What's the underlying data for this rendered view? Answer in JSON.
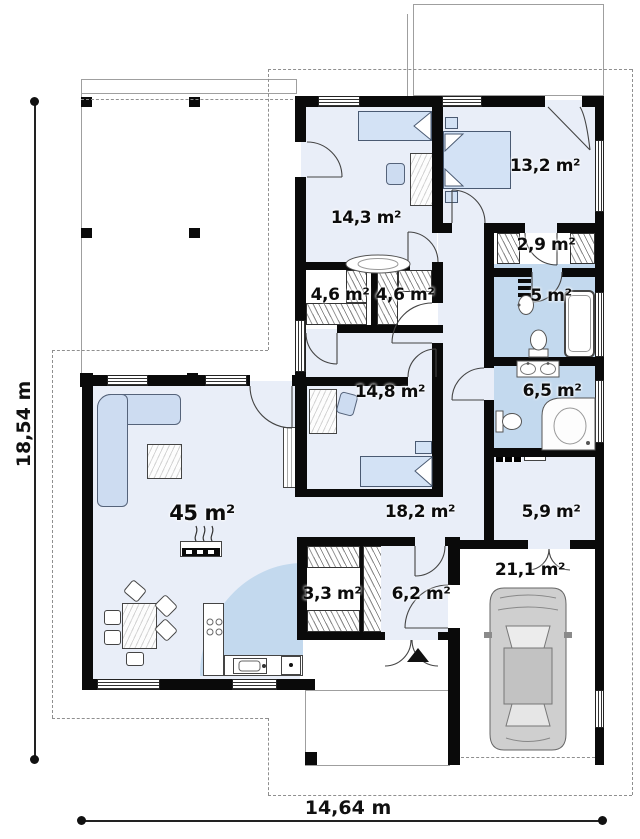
{
  "plan": {
    "type": "floor-plan",
    "rooms": [
      {
        "id": "living-room",
        "area_label": "45 m²"
      },
      {
        "id": "bedroom-1",
        "area_label": "14,3 m²"
      },
      {
        "id": "bedroom-2",
        "area_label": "13,2 m²"
      },
      {
        "id": "bedroom-3",
        "area_label": "14,8 m²"
      },
      {
        "id": "hallway",
        "area_label": "18,2 m²"
      },
      {
        "id": "wardrobe-1",
        "area_label": "2,9 m²"
      },
      {
        "id": "bathroom-1",
        "area_label": "5 m²"
      },
      {
        "id": "closet-1",
        "area_label": "4,6 m²"
      },
      {
        "id": "closet-2",
        "area_label": "4,6 m²"
      },
      {
        "id": "bathroom-2",
        "area_label": "6,5 m²"
      },
      {
        "id": "utility",
        "area_label": "5,9 m²"
      },
      {
        "id": "wardrobe-2",
        "area_label": "3,3 m²"
      },
      {
        "id": "entry",
        "area_label": "6,2 m²"
      },
      {
        "id": "garage",
        "area_label": "21,1 m²"
      }
    ],
    "dimensions": {
      "total_width_label": "14,64 m",
      "total_depth_label": "18,54 m"
    },
    "icons": {
      "entrance_arrow": "▲",
      "car_symbol": "car-top-view",
      "fireplace_symbol": "stove-with-flames"
    },
    "colors": {
      "wall": "#0a0a0a",
      "room_fill": "#e9eef8",
      "bath_fill": "#c3d9ee",
      "furniture_fill": "#cddcf1",
      "outline_dash": "#8f8f8f"
    }
  }
}
